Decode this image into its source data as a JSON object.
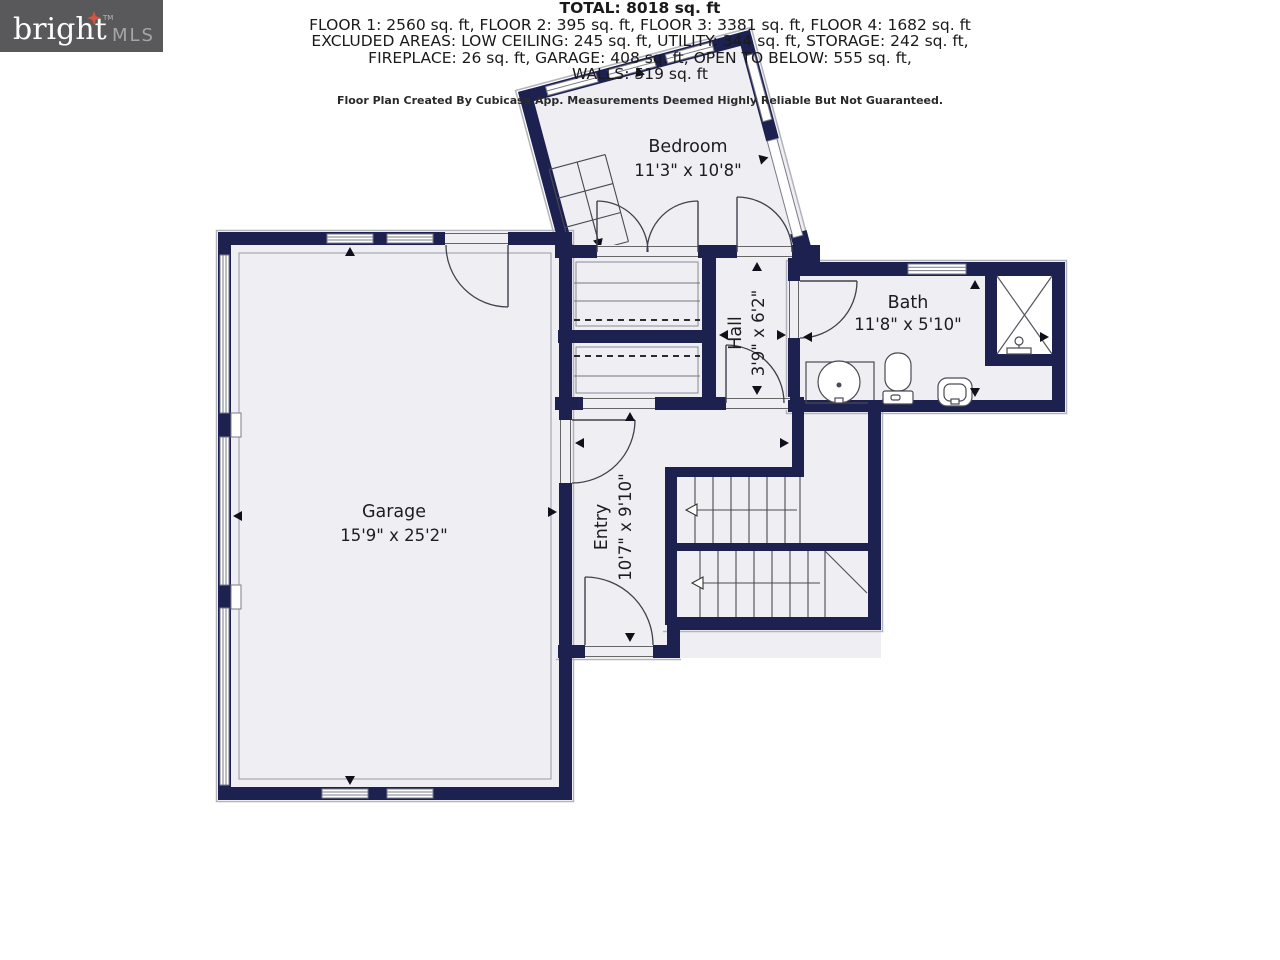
{
  "rooms": [
    {
      "id": "bedroom",
      "name": "Bedroom",
      "dims": "11'3\" x 10'8\""
    },
    {
      "id": "bath",
      "name": "Bath",
      "dims": "11'8\" x 5'10\""
    },
    {
      "id": "hall",
      "name": "Hall",
      "dims": "3'9\" x 6'2\""
    },
    {
      "id": "garage",
      "name": "Garage",
      "dims": "15'9\" x 25'2\""
    },
    {
      "id": "entry",
      "name": "Entry",
      "dims": "10'7\" x 9'10\""
    }
  ],
  "summary": {
    "total": "TOTAL: 8018 sq. ft",
    "floors_line": "FLOOR 1: 2560 sq. ft, FLOOR 2: 395 sq. ft, FLOOR 3: 3381 sq. ft, FLOOR 4: 1682 sq. ft",
    "excluded_line1": "EXCLUDED AREAS: LOW CEILING: 245 sq. ft, UTILITY: 344 sq. ft, STORAGE: 242 sq. ft,",
    "excluded_line2": "FIREPLACE: 26 sq. ft, GARAGE: 408 sq. ft, OPEN TO BELOW: 555 sq. ft,",
    "walls_line": "WALLS: 519 sq. ft",
    "disclaimer": "Floor Plan Created By Cubicasa App. Measurements Deemed Highly Reliable But Not Guaranteed."
  },
  "logo": {
    "brand": "bright",
    "suffix": "MLS",
    "tm": "TM"
  },
  "colors": {
    "wall": "#1d2150",
    "floor": "#efeff3",
    "window": "#7b7b8a",
    "logo_box": "#59595b",
    "logo_star": "#d9543a"
  }
}
